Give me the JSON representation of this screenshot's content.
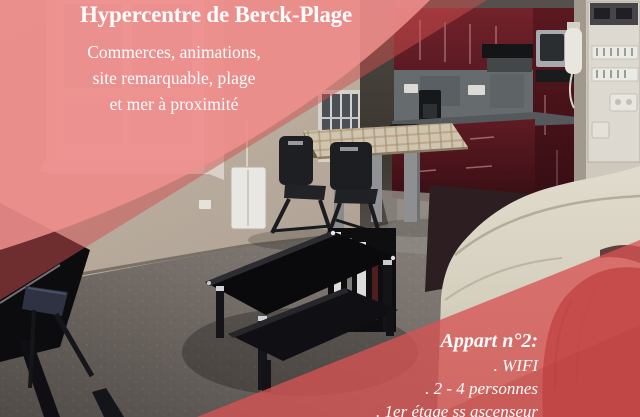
{
  "flyer": {
    "top_banner": {
      "title": "Hypercentre de Berck-Plage",
      "subtitle_lines": [
        "Commerces, animations,",
        "site remarquable, plage",
        "et mer à proximité"
      ]
    },
    "bottom_banner": {
      "heading": "Appart n°2:",
      "features": [
        ". WIFI",
        ". 2 - 4 personnes",
        ". 1er étage ss ascenseur"
      ]
    },
    "colors": {
      "banner_pink": "#f0908e",
      "banner_pink_glass": "#d05050",
      "banner_red": "#d65353",
      "banner_red_deep": "#b23b3b"
    }
  }
}
